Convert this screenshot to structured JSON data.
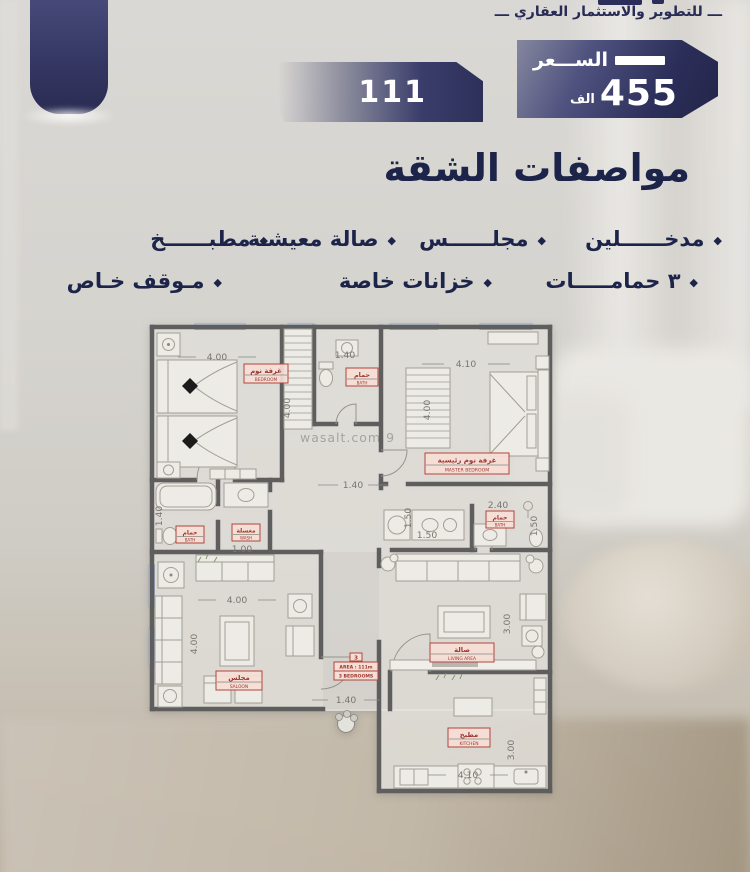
{
  "header": {
    "tagline": "ـــ للتطوير والاستثمار العقاري ـــ",
    "price": {
      "label": "الســـعر",
      "value": "455",
      "unit": "الف"
    },
    "unit_number": "111"
  },
  "specs": {
    "title": "مواصفات الشقة",
    "bullet": "◆",
    "row1": [
      "مدخــــــلين",
      "مجلــــــس",
      "صالة معيشـة",
      "مطبــــــخ"
    ],
    "row2": [
      "٣ حمامـــــات",
      "خزانات خاصة",
      "مـوقف خـاص"
    ]
  },
  "floorplan": {
    "watermark": "wasalt.com 9",
    "rooms": {
      "bedroom": {
        "ar": "غرفة نوم",
        "en": "BEDROOM"
      },
      "bath_top": {
        "ar": "حمام",
        "en": "BATH"
      },
      "master": {
        "ar": "غرفة نوم رئيسية",
        "en": "MASTER BEDROOM"
      },
      "bath_left": {
        "ar": "حمام",
        "en": "BATH"
      },
      "wash": {
        "ar": "مغسلة",
        "en": "WASH"
      },
      "bath_right": {
        "ar": "حمام",
        "en": "BATH"
      },
      "saloon": {
        "ar": "مجلس",
        "en": "SALOON"
      },
      "living": {
        "ar": "صالة",
        "en": "LIVING AREA"
      },
      "kitchen": {
        "ar": "مطبخ",
        "en": "KITCHEN"
      }
    },
    "area_box": {
      "top": "3",
      "mid": "AREA : 111m",
      "bottom": "3 BEDROOMS"
    },
    "dims": {
      "bedroom_w": "4.00",
      "bath_top_w": "1.40",
      "master_w": "4.10",
      "bedroom_h": "4.00",
      "master_h": "4.00",
      "hall_w": "1.40",
      "bath_left_h": "1.40",
      "wash_w": "1.00",
      "bath_right_w": "2.40",
      "laundry_h": "1.50",
      "laundry_w": "1.50",
      "bath_right_h": "1.50",
      "saloon_w": "4.00",
      "saloon_h": "4.00",
      "living_h": "3.00",
      "entrance_w": "1.40",
      "kitchen_h": "3.00",
      "kitchen_w": "4.10"
    }
  },
  "colors": {
    "navy_text": "#1d2449",
    "badge_navy": "#2d3059",
    "label_red": "#a03830",
    "wall_gray": "#5e5e5e",
    "background": "#d5d3ce"
  }
}
